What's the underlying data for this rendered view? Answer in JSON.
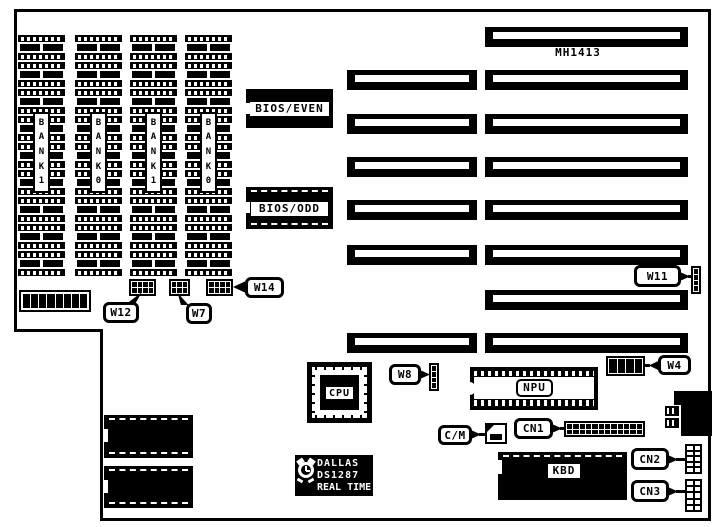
{
  "diagram": {
    "model_number": "MH1413",
    "memory": {
      "banks": [
        "BANK1",
        "BANK0",
        "BANK1",
        "BANK0"
      ],
      "chips_per_bank": 9
    },
    "dip_switch": {
      "positions": 8
    },
    "bios": {
      "even_label": "BIOS/EVEN",
      "odd_label": "BIOS/ODD"
    },
    "expansion_slots": {
      "short_slots": 6,
      "long_slots": 8
    },
    "chips": {
      "cpu_label": "CPU",
      "npu_label": "NPU",
      "kbd_label": "KBD"
    },
    "rtc": {
      "brand": "DALLAS",
      "part": "DS1287",
      "function": "REAL TIME"
    },
    "jumpers": [
      {
        "id": "w12",
        "label": "W12",
        "pin_rows": 2,
        "pin_cols": 4
      },
      {
        "id": "w7",
        "label": "W7",
        "pin_rows": 2,
        "pin_cols": 3
      },
      {
        "id": "w14",
        "label": "W14",
        "pin_rows": 2,
        "pin_cols": 4
      },
      {
        "id": "w11",
        "label": "W11",
        "pin_rows": 4,
        "pin_cols": 1
      },
      {
        "id": "w8",
        "label": "W8",
        "pin_rows": 4,
        "pin_cols": 1
      },
      {
        "id": "w4",
        "label": "W4",
        "pin_rows": 1,
        "pin_cols": 4
      }
    ],
    "connectors": [
      {
        "id": "cm",
        "label": "C/M"
      },
      {
        "id": "cn1",
        "label": "CN1",
        "pin_rows": 2,
        "pin_cols": 12
      },
      {
        "id": "cn2",
        "label": "CN2",
        "pin_rows": 5,
        "pin_cols": 2
      },
      {
        "id": "cn3",
        "label": "CN3",
        "pin_rows": 5,
        "pin_cols": 2
      }
    ],
    "colors": {
      "ink": "#000000",
      "paper": "#ffffff"
    }
  }
}
